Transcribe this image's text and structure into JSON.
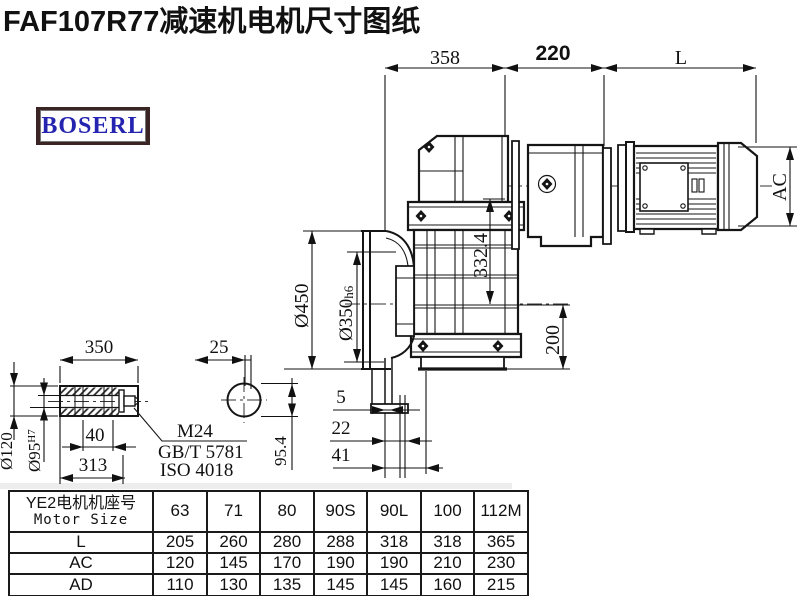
{
  "title": "FAF107R77减速机电机尺寸图纸",
  "logo": {
    "text": "BOSERL"
  },
  "drawing": {
    "top_dims": {
      "left": "358",
      "middle": "220",
      "right": "L"
    },
    "motor": {
      "diameter_label": "AC"
    },
    "gearbox": {
      "center_height": "332.4",
      "bottom_height": "200"
    },
    "flange": {
      "outer_dia": "Ø450",
      "spigot_main": "Ø350",
      "spigot_tol": "h6"
    },
    "offsets": {
      "small": "5",
      "mid": "22",
      "large": "41"
    },
    "shaft": {
      "length": "350",
      "end_dia": "25",
      "flat": "95.4",
      "outer_dia": "Ø120",
      "bore_main": "Ø95",
      "bore_tol": "H7",
      "key_depth": "40",
      "usable_length": "313",
      "bolt": "M24",
      "bolt_std1": "GB/T 5781",
      "bolt_std2": "ISO 4018"
    }
  },
  "table": {
    "header_line1": "YE2电机机座号",
    "header_line2": "Motor Size",
    "sizes": [
      "63",
      "71",
      "80",
      "90S",
      "90L",
      "100",
      "112M"
    ],
    "rows": [
      {
        "label": "L",
        "values": [
          "205",
          "260",
          "280",
          "288",
          "318",
          "318",
          "365"
        ]
      },
      {
        "label": "AC",
        "values": [
          "120",
          "145",
          "170",
          "190",
          "190",
          "210",
          "230"
        ]
      },
      {
        "label": "AD",
        "values": [
          "110",
          "130",
          "135",
          "145",
          "145",
          "160",
          "215"
        ]
      }
    ]
  }
}
